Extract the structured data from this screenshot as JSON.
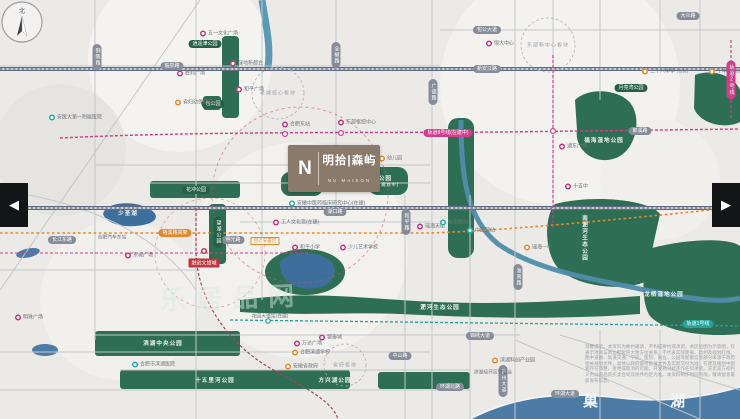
{
  "window": {
    "left_arrow": "◀",
    "right_arrow": "▶"
  },
  "compass": {
    "label": "北"
  },
  "project": {
    "monogram": "N",
    "name": "明拾|森屿",
    "name_en": "NU MAISON"
  },
  "watermark": "乐居品网",
  "water": {
    "lake_bottom": "巢湖",
    "lake_left": "少荃湖"
  },
  "colors": {
    "park": "#2e6e54",
    "water": "#4c7ba6",
    "metro": "#d23c8a",
    "rail": "#27a29b",
    "highway": "#e08a2d",
    "main_road": "#5e6a80",
    "logo": "#8a7a6b"
  },
  "disclaimer": "温馨提示：本资料为要约邀请，不构成要约或承诺。本区位图为示意图，仅表示项目与周边配套的大致方位关系，不代表实际距离、比例及规划红线。图中道路、轨道交通、学校、医院、商业、公园等配套信息部分来源于政府相关规划文件，具体以政府最终批准文件及实际交付为准；在建及规划中配套存在调整、变更或取消的可能，开发商对此不作任何承诺。买卖双方权利义务以商品房买卖合同及附件约定为准。本资料制作时间有限，敬请留意最新发布信息。",
  "pois": [
    {
      "t": "roadv",
      "x": 97,
      "y": 57,
      "label": "铜陵路"
    },
    {
      "t": "road",
      "x": 172,
      "y": 66,
      "label": "临泉路"
    },
    {
      "t": "roadv",
      "x": 336,
      "y": 55,
      "label": "全椒路"
    },
    {
      "t": "road",
      "x": 487,
      "y": 30,
      "label": "包公大道"
    },
    {
      "t": "road",
      "x": 487,
      "y": 69,
      "label": "新安江路"
    },
    {
      "t": "road",
      "x": 688,
      "y": 16,
      "label": "大众路"
    },
    {
      "t": "road",
      "x": 640,
      "y": 131,
      "label": "郎溪路"
    },
    {
      "t": "roadv",
      "x": 433,
      "y": 92,
      "label": "广德路"
    },
    {
      "t": "road",
      "x": 335,
      "y": 212,
      "label": "湖口路"
    },
    {
      "t": "roadv",
      "x": 406,
      "y": 222,
      "label": "和平路"
    },
    {
      "t": "road",
      "x": 62,
      "y": 240,
      "label": "长江东路"
    },
    {
      "t": "road",
      "x": 233,
      "y": 240,
      "label": "明光路"
    },
    {
      "t": "roadv",
      "x": 518,
      "y": 277,
      "label": "淮南路"
    },
    {
      "t": "road",
      "x": 480,
      "y": 336,
      "label": "锦绣大道"
    },
    {
      "t": "road",
      "x": 400,
      "y": 356,
      "label": "中山路"
    },
    {
      "t": "road",
      "x": 450,
      "y": 387,
      "label": "环湖北路"
    },
    {
      "t": "road",
      "x": 565,
      "y": 394,
      "label": "环湖大道"
    },
    {
      "t": "roadv",
      "x": 503,
      "y": 381,
      "label": "庐州大道"
    },
    {
      "t": "hw",
      "x": 175,
      "y": 233,
      "label": "裕溪路高架"
    },
    {
      "t": "metro",
      "x": 448,
      "y": 133,
      "label": "轨道8号线(在建中)"
    },
    {
      "t": "railt",
      "x": 698,
      "y": 324,
      "label": "轨道1号线"
    },
    {
      "t": "metrov",
      "x": 731,
      "y": 80,
      "label": "轨道2号线"
    },
    {
      "t": "park",
      "x": 205,
      "y": 44,
      "label": "逍遥津公园"
    },
    {
      "t": "park",
      "x": 213,
      "y": 104,
      "label": "包公园"
    },
    {
      "t": "park",
      "x": 196,
      "y": 190,
      "label": "花冲公园"
    },
    {
      "t": "parkv",
      "x": 218,
      "y": 232,
      "label": "望湖公园"
    },
    {
      "t": "park",
      "x": 631,
      "y": 88,
      "label": "月亮湾公园"
    },
    {
      "t": "white",
      "x": 604,
      "y": 140,
      "label": "福海湿地公园"
    },
    {
      "t": "whitev",
      "x": 584,
      "y": 238,
      "label": "南淝河生态公园"
    },
    {
      "t": "white",
      "x": 664,
      "y": 294,
      "label": "龙栖湿地公园"
    },
    {
      "t": "white",
      "x": 440,
      "y": 307,
      "label": "淝河生态公园"
    },
    {
      "t": "white",
      "x": 163,
      "y": 343,
      "label": "滨湖中央公园"
    },
    {
      "t": "white",
      "x": 215,
      "y": 380,
      "label": "十五里河公园"
    },
    {
      "t": "white",
      "x": 335,
      "y": 380,
      "label": "方兴湖公园"
    },
    {
      "t": "white",
      "x": 300,
      "y": 186,
      "label": "公园",
      "sub": "(在建中)"
    },
    {
      "t": "white",
      "x": 389,
      "y": 181,
      "label": "公园",
      "sub": "(规划中)"
    },
    {
      "t": "white",
      "x": 352,
      "y": 277,
      "label": "公园"
    },
    {
      "t": "white",
      "x": 128,
      "y": 213,
      "label": "少荃湖"
    },
    {
      "t": "zone",
      "x": 278,
      "y": 93,
      "label": "老城核心板块"
    },
    {
      "t": "zone",
      "x": 548,
      "y": 45,
      "label": "东部新中心板块"
    },
    {
      "t": "zone",
      "x": 345,
      "y": 365,
      "label": "省府板块"
    },
    {
      "t": "pm",
      "x": 203,
      "y": 33,
      "label": "五一文化广场"
    },
    {
      "t": "pm",
      "x": 489,
      "y": 43,
      "label": "恒大中心"
    },
    {
      "t": "pm",
      "x": 180,
      "y": 73,
      "label": "胜利广场"
    },
    {
      "t": "pm",
      "x": 233,
      "y": 63,
      "label": "绿地新都会"
    },
    {
      "t": "pm",
      "x": 239,
      "y": 89,
      "label": "和平广场"
    },
    {
      "t": "pm",
      "x": 285,
      "y": 124,
      "label": "合肥东站"
    },
    {
      "t": "pm",
      "x": 341,
      "y": 122,
      "label": "东部枢纽中心"
    },
    {
      "t": "pm",
      "x": 420,
      "y": 226,
      "label": "瑶海天街"
    },
    {
      "t": "pm",
      "x": 297,
      "y": 343,
      "label": "万达广场"
    },
    {
      "t": "pm",
      "x": 322,
      "y": 337,
      "label": "银泰城"
    },
    {
      "t": "pm",
      "x": 18,
      "y": 317,
      "label": "明珠广场"
    },
    {
      "t": "pm",
      "x": 128,
      "y": 255,
      "label": "东城广场"
    },
    {
      "t": "pm",
      "x": 562,
      "y": 146,
      "label": "湖东广场"
    },
    {
      "t": "pm",
      "x": 568,
      "y": 186,
      "label": "十五中"
    },
    {
      "t": "pm",
      "x": 295,
      "y": 247,
      "label": "和平小学"
    },
    {
      "t": "pm",
      "x": 343,
      "y": 247,
      "label": "少儿艺术学校"
    },
    {
      "t": "pm",
      "x": 276,
      "y": 222,
      "label": "工人文化宫(在建)"
    },
    {
      "t": "po",
      "x": 178,
      "y": 102,
      "label": "省妇幼保健院"
    },
    {
      "t": "po",
      "x": 382,
      "y": 158,
      "label": "幼儿园"
    },
    {
      "t": "po",
      "x": 645,
      "y": 71,
      "label": "三十八中学",
      "sub": "(在建)"
    },
    {
      "t": "po",
      "x": 712,
      "y": 71,
      "label": "十中",
      "sub": "(规划)"
    },
    {
      "t": "po",
      "x": 527,
      "y": 247,
      "label": "瑶海一中"
    },
    {
      "t": "po",
      "x": 295,
      "y": 352,
      "label": "合肥滨湖学校"
    },
    {
      "t": "po",
      "x": 288,
      "y": 366,
      "label": "安徽省政府"
    },
    {
      "t": "po",
      "x": 495,
      "y": 360,
      "label": "滨湖科创产业园"
    },
    {
      "t": "obox",
      "x": 265,
      "y": 241,
      "label": "回迁安置区"
    },
    {
      "t": "pt",
      "x": 52,
      "y": 117,
      "label": "安医大第一附属医院"
    },
    {
      "t": "pt",
      "x": 292,
      "y": 203,
      "label": "安徽中医药临床研究中心(在建)"
    },
    {
      "t": "pt",
      "x": 443,
      "y": 222,
      "label": "枞阳路站"
    },
    {
      "t": "pt",
      "x": 470,
      "y": 230,
      "label": "中医院站"
    },
    {
      "t": "pt",
      "x": 135,
      "y": 364,
      "label": "合肥市滨湖医院"
    },
    {
      "t": "pr",
      "x": 204,
      "y": 251,
      "label": ""
    },
    {
      "t": "prbox",
      "x": 204,
      "y": 263,
      "label": "融创文旅城"
    },
    {
      "t": "txt",
      "x": 112,
      "y": 237,
      "label": "合肥汽车东站"
    },
    {
      "t": "txt",
      "x": 493,
      "y": 372,
      "label": "滨湖经开区管委会"
    },
    {
      "t": "txt",
      "x": 270,
      "y": 316,
      "label": "花园大道站(在建)"
    }
  ]
}
